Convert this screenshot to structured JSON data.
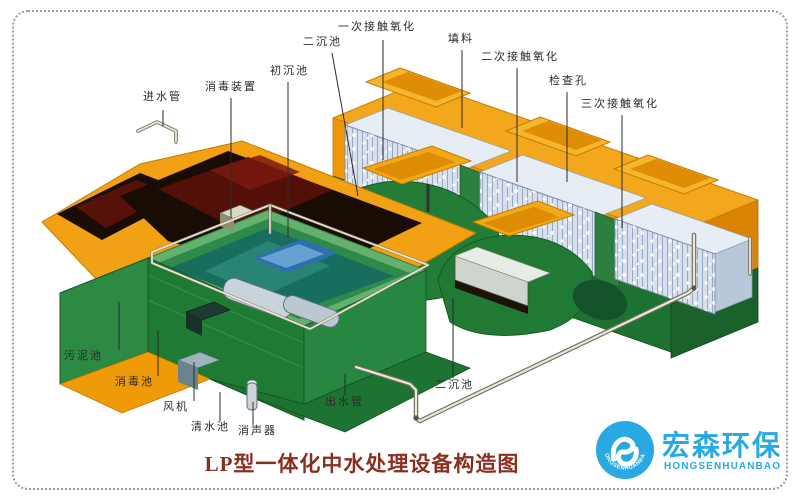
{
  "diagram": {
    "title": "LP型一体化中水处理设备构造图",
    "labels": [
      {
        "id": "inlet-pipe",
        "text": "进水管",
        "x": 143,
        "y": 92,
        "lx1": 163,
        "ly1": 110,
        "lx2": 163,
        "ly2": 126
      },
      {
        "id": "disinfection-device",
        "text": "消毒装置",
        "x": 205,
        "y": 82,
        "lx1": 231,
        "ly1": 98,
        "lx2": 231,
        "ly2": 218
      },
      {
        "id": "primary-settling-tank",
        "text": "初沉池",
        "x": 270,
        "y": 66,
        "lx1": 288,
        "ly1": 82,
        "lx2": 288,
        "ly2": 238
      },
      {
        "id": "secondary-settling-tank-top",
        "text": "二沉池",
        "x": 303,
        "y": 37,
        "lx1": 332,
        "ly1": 53,
        "lx2": 358,
        "ly2": 196
      },
      {
        "id": "primary-contact-oxidation",
        "text": "一次接触氧化",
        "x": 338,
        "y": 22,
        "lx1": 383,
        "ly1": 40,
        "lx2": 383,
        "ly2": 160
      },
      {
        "id": "packing",
        "text": "填料",
        "x": 448,
        "y": 34,
        "lx1": 462,
        "ly1": 50,
        "lx2": 462,
        "ly2": 128
      },
      {
        "id": "secondary-contact-oxidation",
        "text": "二次接触氧化",
        "x": 481,
        "y": 52,
        "lx1": 517,
        "ly1": 68,
        "lx2": 517,
        "ly2": 182
      },
      {
        "id": "inspection-hole",
        "text": "检查孔",
        "x": 549,
        "y": 76,
        "lx1": 567,
        "ly1": 92,
        "lx2": 567,
        "ly2": 182
      },
      {
        "id": "tertiary-contact-oxidation",
        "text": "三次接触氧化",
        "x": 581,
        "y": 99,
        "lx1": 622,
        "ly1": 115,
        "lx2": 622,
        "ly2": 228
      },
      {
        "id": "sludge-tank",
        "text": "污泥池",
        "x": 64,
        "y": 351,
        "lx1": 119,
        "ly1": 350,
        "lx2": 119,
        "ly2": 302
      },
      {
        "id": "disinfection-tank",
        "text": "消毒池",
        "x": 115,
        "y": 377,
        "lx1": 158,
        "ly1": 376,
        "lx2": 158,
        "ly2": 330
      },
      {
        "id": "blower",
        "text": "风机",
        "x": 163,
        "y": 402,
        "lx1": 194,
        "ly1": 401,
        "lx2": 194,
        "ly2": 362
      },
      {
        "id": "clean-water-tank",
        "text": "清水池",
        "x": 191,
        "y": 422,
        "lx1": 220,
        "ly1": 421,
        "lx2": 220,
        "ly2": 392
      },
      {
        "id": "muffler",
        "text": "消声器",
        "x": 238,
        "y": 426,
        "lx1": 253,
        "ly1": 425,
        "lx2": 253,
        "ly2": 402
      },
      {
        "id": "outlet-pipe",
        "text": "出水管",
        "x": 325,
        "y": 397,
        "lx1": 345,
        "ly1": 395,
        "lx2": 345,
        "ly2": 374
      },
      {
        "id": "secondary-settling-tank-bottom",
        "text": "二沉池",
        "x": 435,
        "y": 380,
        "lx1": 453,
        "ly1": 378,
        "lx2": 453,
        "ly2": 298
      }
    ]
  },
  "logo": {
    "company_cn": "宏森环保",
    "company_en": "HONGSENHUANBAO",
    "ring_text": "HONGSENHUANBAO"
  },
  "colors": {
    "logo-blue": "#29a9e1",
    "title-red": "#8a2f1f",
    "body-orange": "#f3a114",
    "tank-green": "#1f7a33",
    "water-teal": "#186e5e",
    "packing-blue": "#d7e0ec",
    "cavity-dark": "#190c05",
    "maroon-red": "#531009",
    "label-ink": "#2b2b2b",
    "border-gray": "#9b9b9b"
  }
}
